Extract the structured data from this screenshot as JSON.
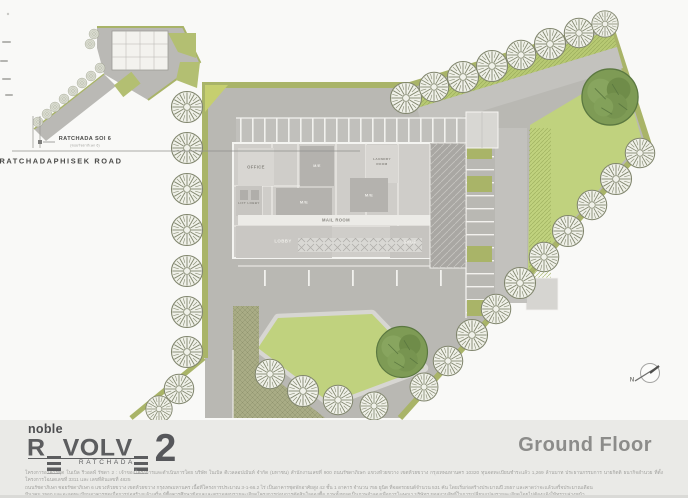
{
  "inset": {
    "soi_label": "RATCHADA SOI 6",
    "soi_sublabel": "(ซอยรัชดาภิเษก 6)",
    "road_label": "RATCHADAPHISEK ROAD"
  },
  "plan": {
    "rooms": {
      "office": "OFFICE",
      "lift_lobby": "LIFT LOBBY",
      "me_top": "M/E",
      "me_center": "M/E",
      "me_right": "M/E",
      "laundry_line1": "LAUNDRY",
      "laundry_line2": "ROOM",
      "mail_room": "MAIL ROOM",
      "lobby": "LOBBY",
      "shop": "SHOP"
    },
    "compass": "N"
  },
  "footer": {
    "brand": "noble",
    "logo_letters": [
      "R",
      "E",
      "V",
      "O",
      "L",
      "V",
      "E"
    ],
    "logo_number": "2",
    "logo_sub": "RATCHADA",
    "floor_title": "Ground Floor",
    "disclaimer_lines": [
      "โครงการอาคารชุด โนเบิล รีวอลฟ์ รัชดา 2 : เจ้าของโครงการและดำเนินการโดย บริษัท โนเบิล ดีเวลลอปเม้นท์ จำกัด (มหาชน) สำนักงานเลขที่ 900 ถนนรัชดาภิเษก แขวงห้วยขวาง เขตห้วยขวาง กรุงเทพมหานคร 10320 ทุนจดทะเบียนชำระแล้ว 1,269 ล้านบาท ประธานกรรมการ นายกิตติ ธนากิจอำนวย ที่ตั้งโครงการโฉนดเลขที่ 3311 และ เลขที่ดินเลขที่ 4825",
      "ถนนรัชดาภิเษก ซอยรัชดาภิเษก 6 แขวงห้วยขวาง เขตห้วยขวาง กรุงเทพมหานคร เนื้อที่โครงการประมาณ 3-1-66.2 ไร่ เป็นอาคารชุดพักอาศัยสูง 42 ชั้น 1 อาคาร จำนวน 755 ยูนิต ที่จอดรถยนต์จำนวน 531 คัน โดยเริ่มก่อสร้างประมาณปี 2557 และคาดว่าจะแล้วเสร็จประมาณเดือน",
      "มีนาคม 2560 และจะจดทะเบียนอาคารชุดเมื่อการก่อสร้างแล้วเสร็จ ผู้ซื้อควรศึกษาข้อมูลและตรวจสอบรายละเอียดโครงการก่อนการตัดสินใจจองซื้อ ภาพทั้งหมดเป็นภาพจำลองเพื่อการโฆษณา บริษัทฯ ขอสงวนสิทธิ์ในการเปลี่ยนแปลงรายละเอียดโดยไม่ต้องแจ้งให้ทราบล่วงหน้า"
    ]
  },
  "colors": {
    "site_gray": "#b9b8b3",
    "lawn_green": "#c0d27e",
    "olive_strip": "#a9b468",
    "dense_tree": "#7e9b55",
    "footer_bg": "#eaeae7",
    "title_gray": "#8c8c8a",
    "logo_dark": "#5c5d5f"
  }
}
